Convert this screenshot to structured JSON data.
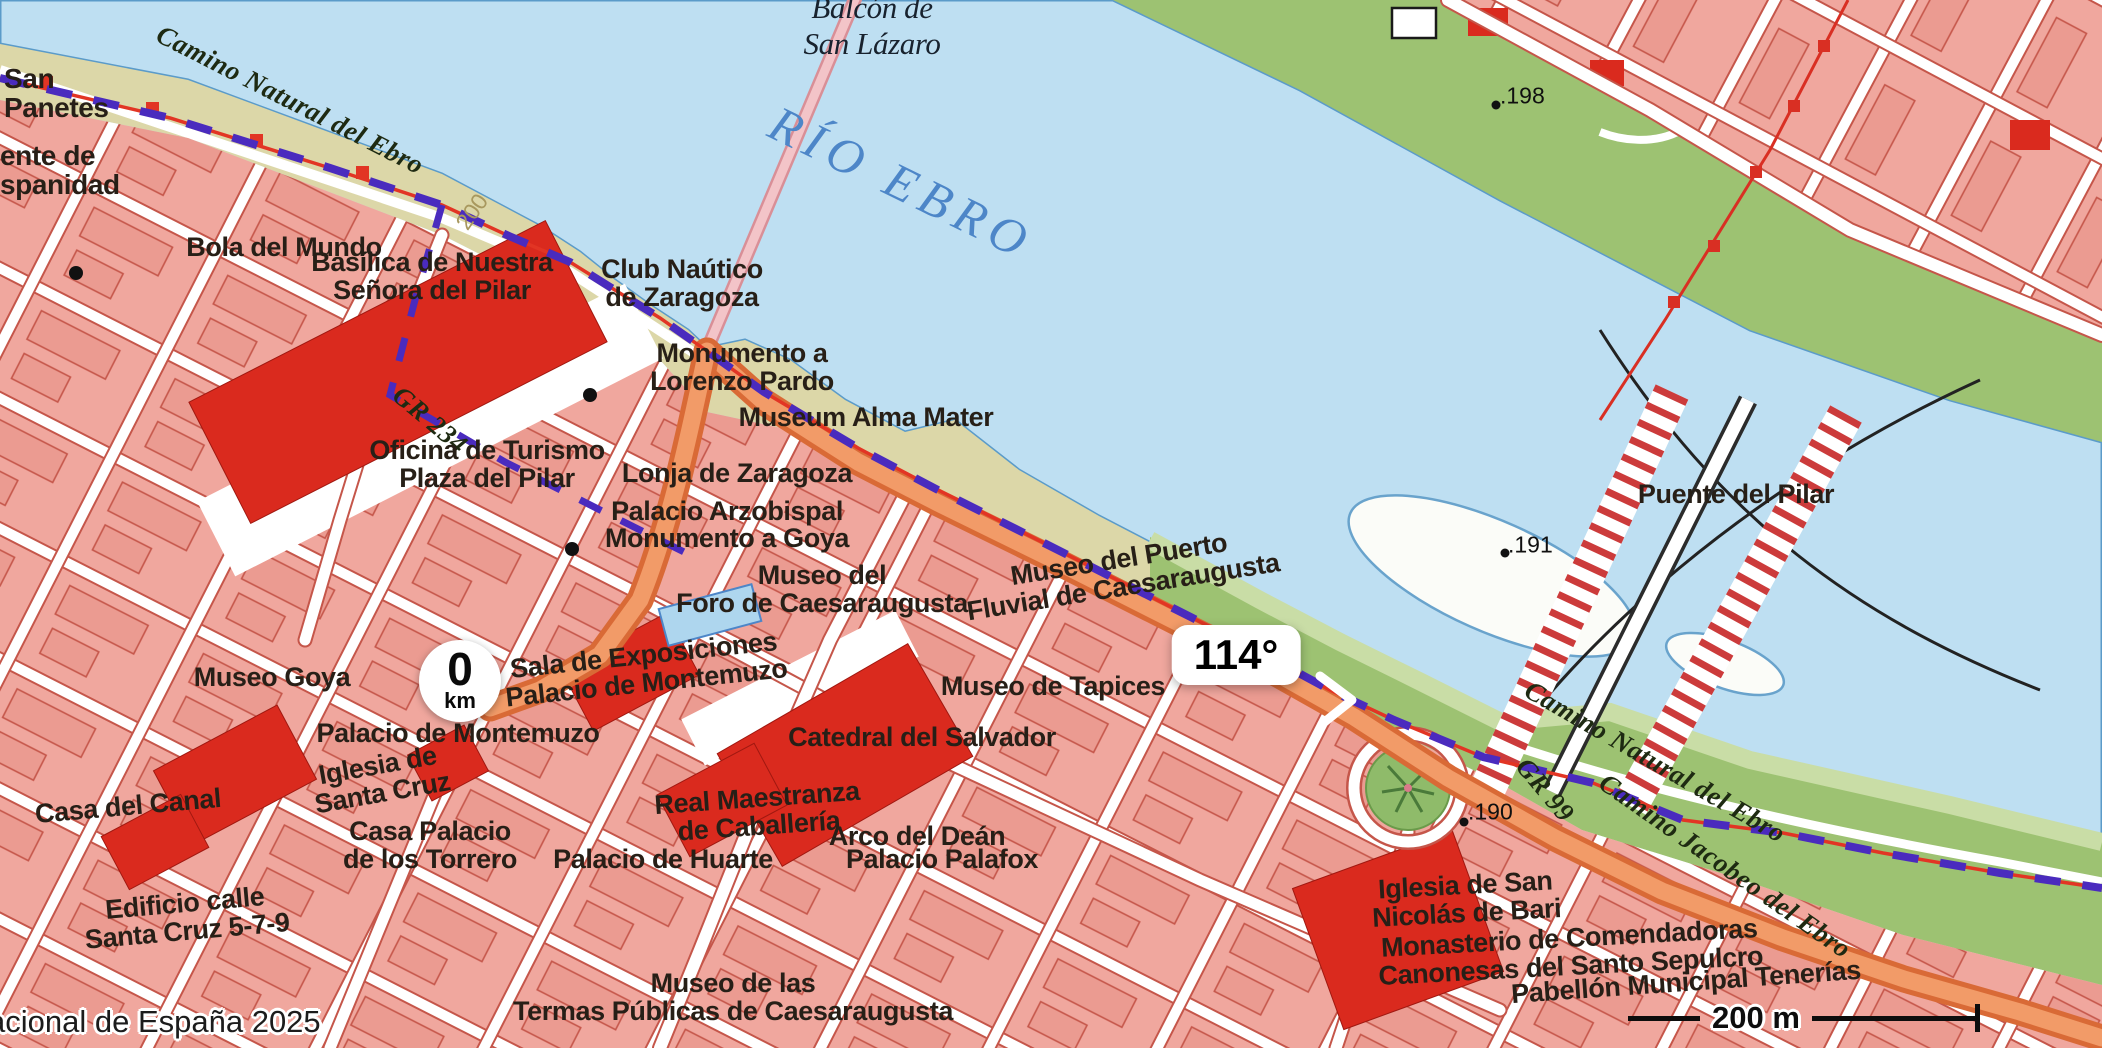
{
  "ui": {
    "bearing_badge": "114°",
    "start_marker": {
      "value": "0",
      "unit": "km"
    },
    "scale_bar_label": "200 m",
    "attribution": "acional de España 2025"
  },
  "colors": {
    "water": "#bedff2",
    "water_edge": "#5b9bc9",
    "bank_khaki": "#dcd7a8",
    "bank_green": "#9dc272",
    "urban_pink": "#f0a79e",
    "street_casing": "#c5564a",
    "building_red": "#da2a1e",
    "route_orange": "#ef8a50",
    "trail_purple": "#4a2bbe",
    "gr_red": "#e23524",
    "river_label_blue": "#4d86c8"
  },
  "map": {
    "labels": [
      {
        "name": "label-san-panetes",
        "text": "San\nPanetes",
        "x": 4,
        "y": 93,
        "align": "left",
        "size": 28
      },
      {
        "name": "label-puente-hispanidad",
        "text": "ente de\nspanidad",
        "x": 0,
        "y": 170,
        "align": "left",
        "size": 28
      },
      {
        "name": "label-camino-natural-oeste",
        "text": "Camino Natural del Ebro",
        "x": 290,
        "y": 100,
        "rot": 27,
        "cls": "camino",
        "size": 27
      },
      {
        "name": "label-contour-200",
        "text": "200",
        "x": 472,
        "y": 212,
        "rot": -55,
        "cls": "contour",
        "size": 23
      },
      {
        "name": "label-balcon-san-lazaro",
        "text": "Balcón de\nSan Lázaro",
        "x": 872,
        "y": 26,
        "cls": "serif-place",
        "size": 31
      },
      {
        "name": "label-rio-ebro",
        "text": "RÍO EBRO",
        "x": 902,
        "y": 183,
        "rot": 26,
        "cls": "river",
        "size": 50
      },
      {
        "name": "label-bola-del-mundo",
        "text": "Bola del Mundo",
        "x": 284,
        "y": 247,
        "size": 27
      },
      {
        "name": "label-basilica",
        "text": "Basílica de Nuestra\nSeñora del Pilar",
        "x": 432,
        "y": 276,
        "size": 27
      },
      {
        "name": "label-club-nautico",
        "text": "Club Naútico\nde Zaragoza",
        "x": 682,
        "y": 283,
        "size": 27
      },
      {
        "name": "label-monumento-lorenzo-pardo",
        "text": "Monumento a\nLorenzo Pardo",
        "x": 742,
        "y": 367,
        "size": 27
      },
      {
        "name": "label-museum-alma-mater",
        "text": "Museum Alma Mater",
        "x": 866,
        "y": 417,
        "size": 27
      },
      {
        "name": "label-gr-234",
        "text": "GR 234",
        "x": 430,
        "y": 420,
        "rot": 40,
        "cls": "camino",
        "size": 27
      },
      {
        "name": "label-oficina-turismo",
        "text": "Oficina de Turismo\nPlaza del Pilar",
        "x": 487,
        "y": 464,
        "size": 27
      },
      {
        "name": "label-lonja",
        "text": "Lonja de Zaragoza",
        "x": 737,
        "y": 473,
        "size": 27
      },
      {
        "name": "label-palacio-arzobispal",
        "text": "Palacio Arzobispal",
        "x": 727,
        "y": 511,
        "size": 27
      },
      {
        "name": "label-monumento-goya",
        "text": "Monumento a Goya",
        "x": 727,
        "y": 538,
        "size": 27
      },
      {
        "name": "label-museo-foro",
        "text": "Museo del\nForo de Caesaraugusta",
        "x": 822,
        "y": 589,
        "size": 27
      },
      {
        "name": "label-museo-puerto-fluvial",
        "text": "Museo del Puerto\nFluvial de Caesaraugusta",
        "x": 1121,
        "y": 573,
        "rot": -9,
        "size": 27
      },
      {
        "name": "label-museo-tapices",
        "text": "Museo de Tapices",
        "x": 1053,
        "y": 686,
        "size": 27
      },
      {
        "name": "label-sala-exposiciones",
        "text": "Sala de Exposiciones\nPalacio de Montemuzo",
        "x": 645,
        "y": 669,
        "rot": -6,
        "size": 27
      },
      {
        "name": "label-museo-goya",
        "text": "Museo Goya",
        "x": 272,
        "y": 677,
        "size": 27
      },
      {
        "name": "label-palacio-montemuzo",
        "text": "Palacio de Montemuzo",
        "x": 458,
        "y": 733,
        "size": 27
      },
      {
        "name": "label-iglesia-santa-cruz",
        "text": "Iglesia de\nSanta Cruz",
        "x": 380,
        "y": 779,
        "rot": -10,
        "size": 27
      },
      {
        "name": "label-casa-del-canal",
        "text": "Casa del Canal",
        "x": 128,
        "y": 806,
        "rot": -5,
        "size": 27
      },
      {
        "name": "label-casa-palacio-torrero",
        "text": "Casa Palacio\nde los Torrero",
        "x": 430,
        "y": 845,
        "size": 27
      },
      {
        "name": "label-edificio-santa-cruz",
        "text": "Edificio calle\nSanta Cruz 5-7-9",
        "x": 186,
        "y": 917,
        "rot": -5,
        "size": 27
      },
      {
        "name": "label-catedral",
        "text": "Catedral del Salvador",
        "x": 922,
        "y": 737,
        "size": 27
      },
      {
        "name": "label-real-maestranza",
        "text": "Real Maestranza\nde Caballería",
        "x": 758,
        "y": 812,
        "rot": -4,
        "size": 27
      },
      {
        "name": "label-arco-dean",
        "text": "Arco del Deán",
        "x": 917,
        "y": 836,
        "size": 27
      },
      {
        "name": "label-palacio-huarte",
        "text": "Palacio de Huarte",
        "x": 663,
        "y": 859,
        "size": 27
      },
      {
        "name": "label-palacio-palafox",
        "text": "Palacio Palafox",
        "x": 942,
        "y": 859,
        "size": 27
      },
      {
        "name": "label-museo-termas",
        "text": "Museo de las\nTermas Públicas de Caesaraugusta",
        "x": 733,
        "y": 997,
        "size": 27
      },
      {
        "name": "label-puente-del-pilar",
        "text": "Puente del Pilar",
        "x": 1736,
        "y": 494,
        "size": 27
      },
      {
        "name": "label-iglesia-san-nicolas",
        "text": "Iglesia de San\nNicolás de Bari",
        "x": 1466,
        "y": 899,
        "rot": -3,
        "size": 27
      },
      {
        "name": "label-monasterio-comendadoras",
        "text": "Monasterio de Comendadoras\nCanonesas del Santo Sepulcro",
        "x": 1570,
        "y": 952,
        "rot": -3,
        "size": 27
      },
      {
        "name": "label-pabellon-tenerias",
        "text": "Pabellón Municipal Tenerías",
        "x": 1686,
        "y": 982,
        "rot": -4,
        "size": 27
      },
      {
        "name": "label-camino-natural-este",
        "text": "Camino Natural del Ebro",
        "x": 1655,
        "y": 762,
        "rot": 30,
        "cls": "camino",
        "size": 27
      },
      {
        "name": "label-gr-99",
        "text": "GR 99",
        "x": 1545,
        "y": 790,
        "rot": 50,
        "cls": "camino",
        "size": 27
      },
      {
        "name": "label-camino-jacobeo",
        "text": "Camino Jacobeo del Ebro",
        "x": 1725,
        "y": 866,
        "rot": 35,
        "cls": "camino",
        "size": 27
      },
      {
        "name": "label-elev-198",
        "text": ".198",
        "x": 1500,
        "y": 96,
        "cls": "elev",
        "align": "left",
        "size": 23
      },
      {
        "name": "label-elev-191",
        "text": ".191",
        "x": 1508,
        "y": 545,
        "cls": "elev",
        "align": "left",
        "size": 23
      },
      {
        "name": "label-elev-190",
        "text": ".190",
        "x": 1468,
        "y": 812,
        "cls": "elev",
        "align": "left",
        "size": 23
      }
    ]
  }
}
